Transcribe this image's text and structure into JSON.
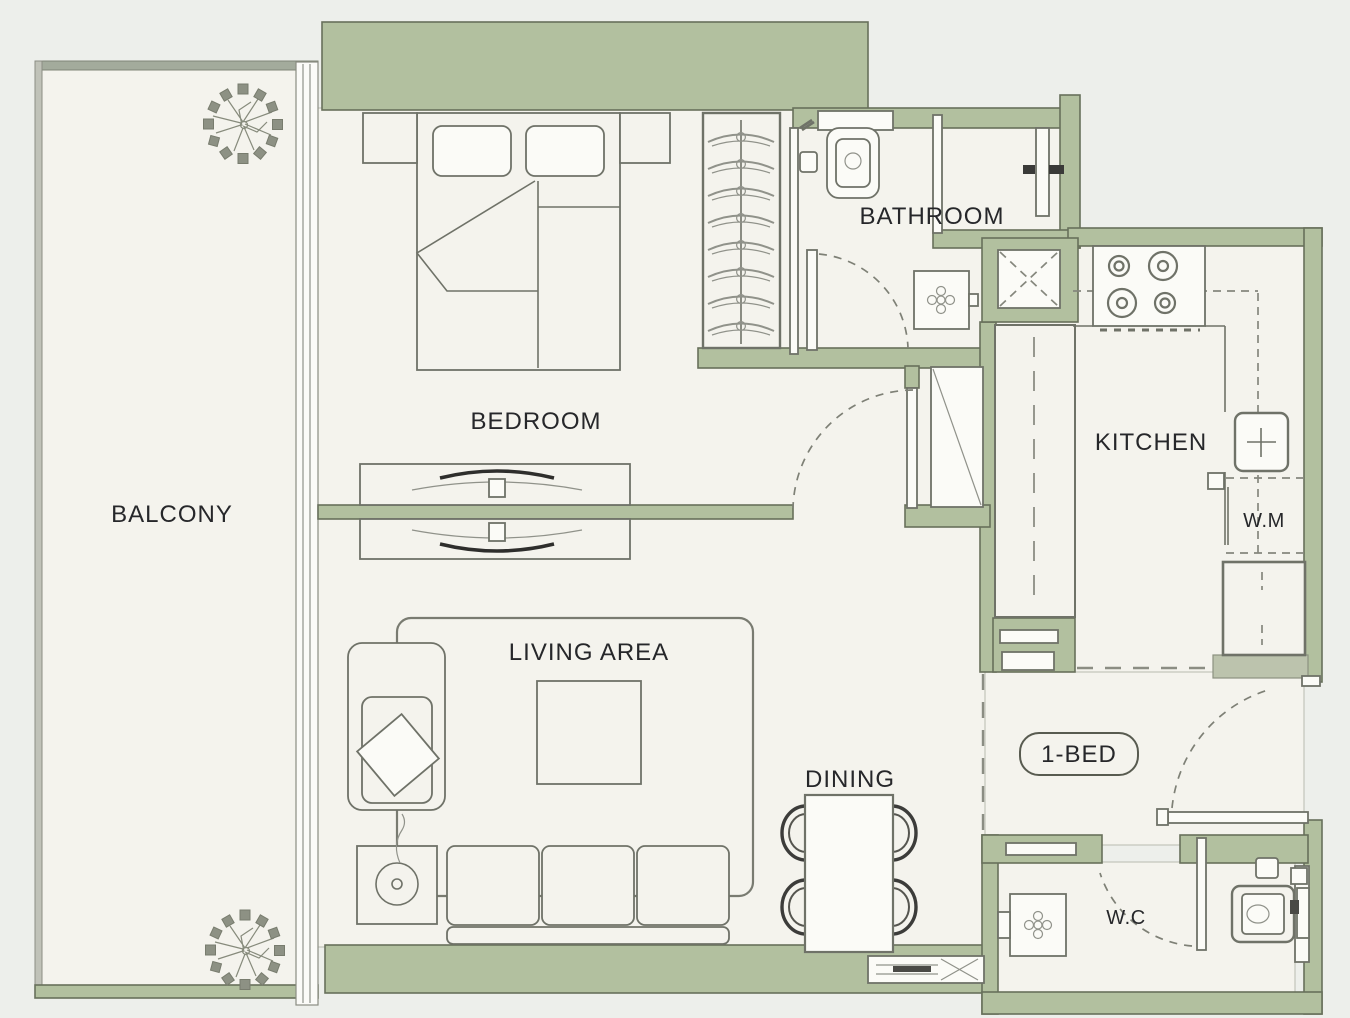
{
  "title": "1-BED apartment floor plan",
  "colors": {
    "background": "#edefeb",
    "floor": "#f4f3ed",
    "wall": "#b2c09f",
    "wall-dark": "#68705b",
    "line": "#6f7268",
    "text": "#26272a"
  },
  "labels": {
    "balcony": "BALCONY",
    "bedroom": "BEDROOM",
    "bathroom": "BATHROOM",
    "kitchen": "KITCHEN",
    "living_area": "LIVING AREA",
    "dining": "DINING",
    "wc": "W.C",
    "washing_machine": "W.M",
    "unit_type": "1-BED"
  }
}
